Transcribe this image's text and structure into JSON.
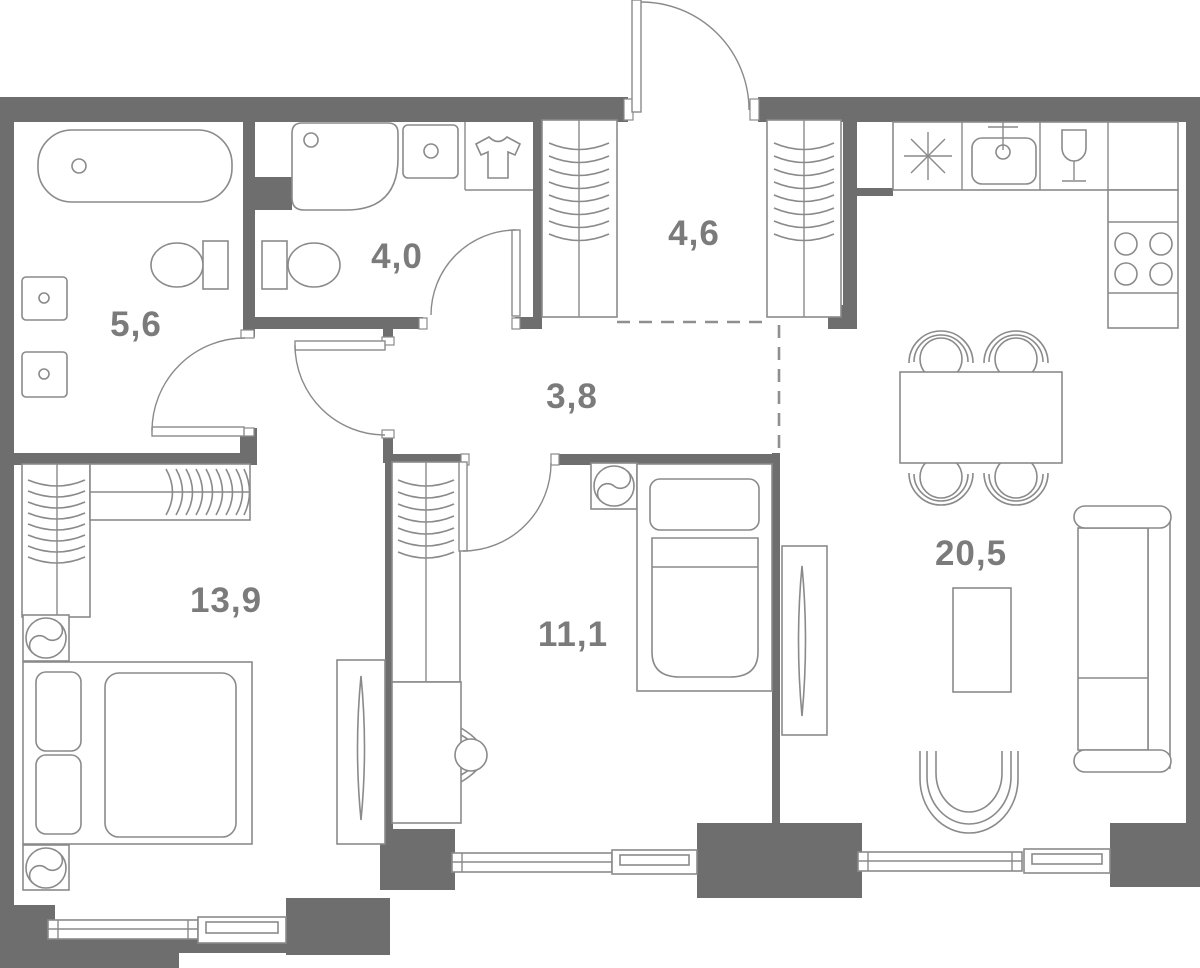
{
  "title": "apartment-floor-plan",
  "rooms": [
    {
      "id": "bathroom",
      "area_label": "5,6"
    },
    {
      "id": "shower-room",
      "area_label": "4,0"
    },
    {
      "id": "entry-wardrobe",
      "area_label": "4,6"
    },
    {
      "id": "hallway",
      "area_label": "3,8"
    },
    {
      "id": "bedroom-main",
      "area_label": "13,9"
    },
    {
      "id": "bedroom-second",
      "area_label": "11,1"
    },
    {
      "id": "kitchen-living",
      "area_label": "20,5"
    }
  ],
  "icons": [
    "bathtub",
    "washbasin-cabinet",
    "toilet",
    "shower-tray",
    "laundry-tshirt-icon",
    "wardrobe-hangers",
    "entrance-door",
    "refrigerator-snowflake-icon",
    "kitchen-sink-faucet-icon",
    "wine-glass-icon",
    "cooktop-4-burners",
    "dining-table-4-chairs",
    "sofa",
    "armchair",
    "coffee-table",
    "double-bed",
    "single-bed",
    "desk-chair",
    "nightstand-yin-yang",
    "mirror-wardrobe",
    "window",
    "dashed-zone-boundary"
  ],
  "colors": {
    "wall": "#6e6e6e",
    "furniture_line": "#8a8a8a",
    "label_text": "#7b7b7b",
    "background": "#ffffff"
  }
}
